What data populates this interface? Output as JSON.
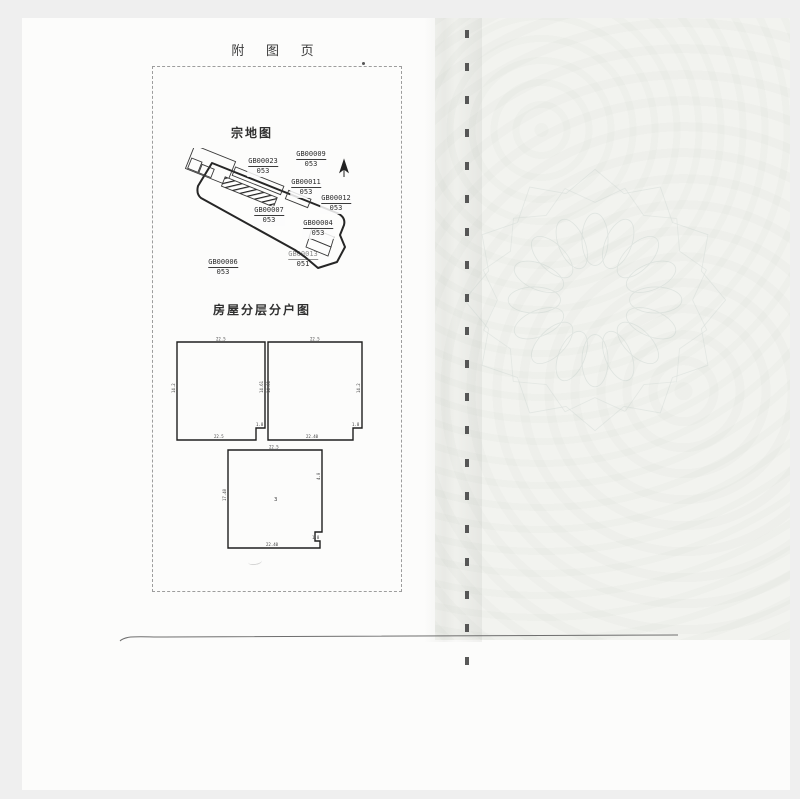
{
  "page": {
    "header_title": "附 图 页"
  },
  "parcel_map": {
    "title": "宗地图",
    "parcels": [
      {
        "id": "GB00023",
        "zone": "053"
      },
      {
        "id": "GB00009",
        "zone": "053"
      },
      {
        "id": "GB00011",
        "zone": "053"
      },
      {
        "id": "GB00012",
        "zone": "053"
      },
      {
        "id": "GB00007",
        "zone": "053"
      },
      {
        "id": "GB00004",
        "zone": "053"
      },
      {
        "id": "GB00006",
        "zone": "053"
      },
      {
        "id": "GB00013",
        "zone": "051"
      }
    ]
  },
  "floor_plan": {
    "title": "房屋分层分户图",
    "units": [
      {
        "top": "22.5",
        "bottom": "22.5",
        "left": "14.2",
        "right": "14.61",
        "notch": "1.8"
      },
      {
        "top": "22.5",
        "bottom": "22.40",
        "left": "14.61",
        "right": "14.2",
        "notch": "1.8"
      },
      {
        "top": "22.5",
        "bottom": "22.40",
        "left": "17.40",
        "right": "4.0",
        "notch": "1.8",
        "room": "3"
      }
    ]
  },
  "colors": {
    "paper": "#fcfcfb",
    "scan_background": "#efefef",
    "ink": "#2e2e2e",
    "watermark": "#b9c6c2",
    "fold_tint": "#f2f3ef"
  }
}
